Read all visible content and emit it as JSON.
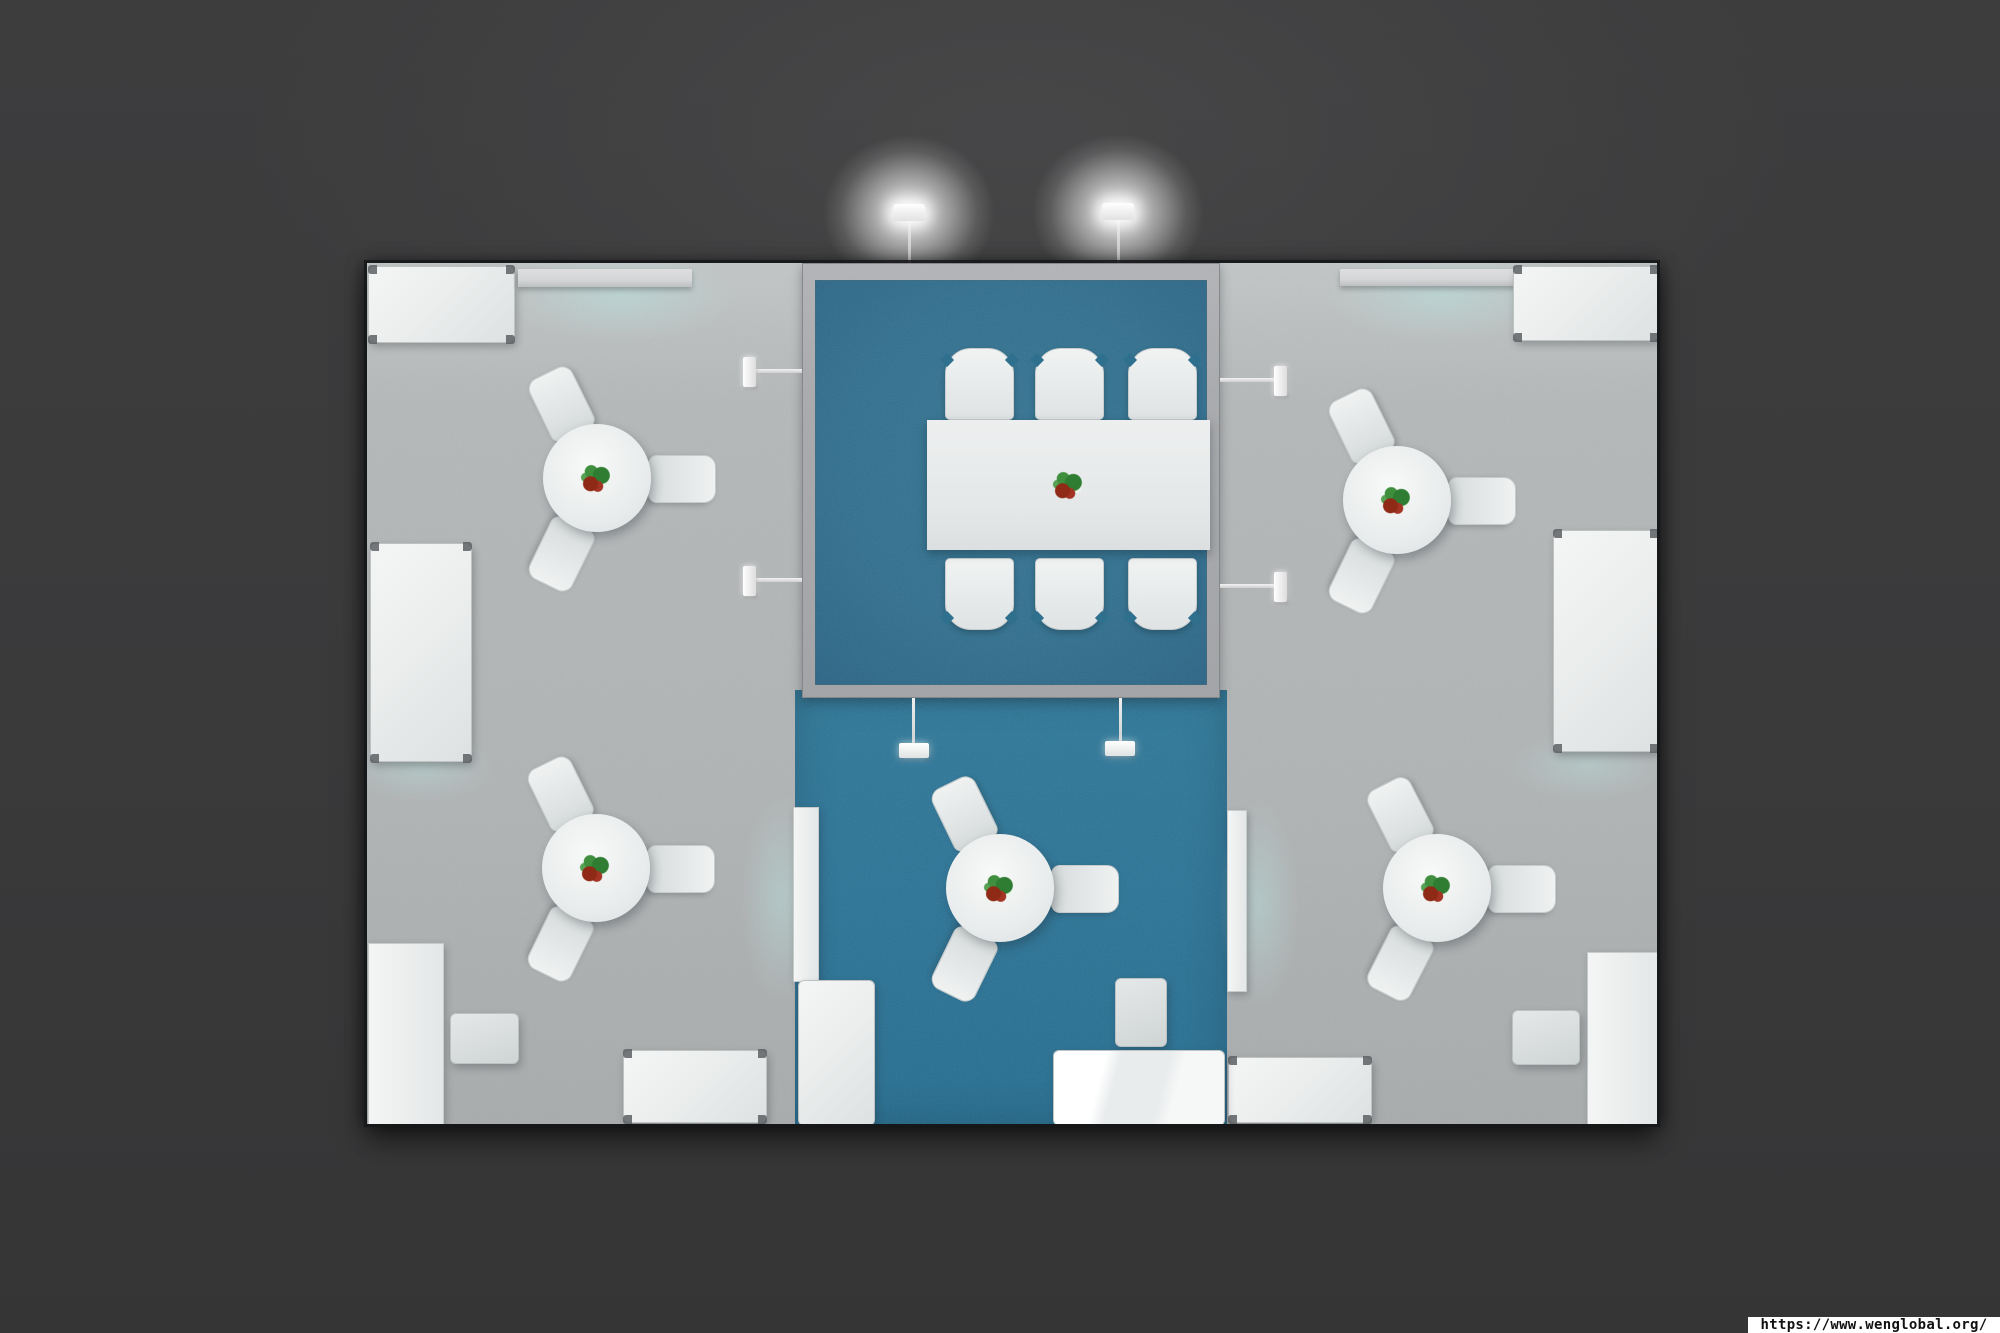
{
  "page": {
    "type": "3d-top-view-render",
    "title": "Exhibition booth floor plan - top view"
  },
  "watermark": {
    "url": "https://www.wenglobal.org/"
  },
  "colors": {
    "background": "#3b3b3c",
    "floor_gray": "#b5b8b9",
    "floor_blue_meeting": "#30708f",
    "floor_blue_lounge": "#2b7396",
    "wall_gray": "#a9aaad",
    "furniture_white": "#eceeee",
    "shelf_gray": "#d5d6d8",
    "glow_teal": "#b8e2de",
    "flower_red": "#8e2a16",
    "flower_green": "#3f8f3f"
  },
  "scene": {
    "areas": [
      "left gray lounge",
      "central meeting room (blue carpet)",
      "central open lounge (blue carpet)",
      "right gray lounge"
    ],
    "counts": {
      "round_tables": 5,
      "chairs_per_round_table": 3,
      "conference_chairs": 6,
      "ceiling_lamps": 2,
      "pendant_lamps": 2,
      "wall_lights": 4,
      "cabinets_and_counters": 16
    }
  }
}
